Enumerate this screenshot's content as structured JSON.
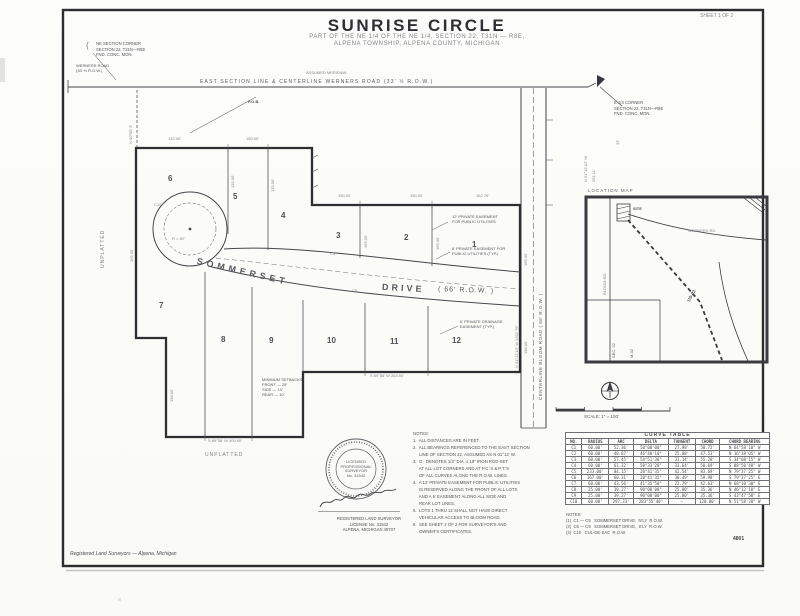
{
  "doc": {
    "title": "SUNRISE CIRCLE",
    "subtitle_line1": "PART OF THE NE 1/4 OF THE NE 1/4, SECTION 22, T31N — R8E,",
    "subtitle_line2": "ALPENA TOWNSHIP, ALPENA COUNTY, MICHIGAN",
    "sheet_note": "SHEET 1 OF 2",
    "footer_left": "Registered Land Surveyors — Alpena, Michigan",
    "footer_right": "4801"
  },
  "top": {
    "corner_bracket": "{",
    "corner_note_nw": [
      "NE SECTION CORNER",
      "SECTION 22, T31N—R8E",
      "FND. CONC. MON."
    ],
    "road_label_1": "WERNERS ROAD",
    "road_label_2": "(33' ½ R.O.W.)",
    "meridian_note": "ASSUMED MERIDIAN",
    "section_line_label": "EAST SECTION LINE & CENTERLINE WERNERS ROAD (33' ½ R.O.W.)",
    "pob_label": "P.O.B.",
    "corner_note_ne": [
      "E 1/4 CORNER",
      "SECTION 22, T31N—R8E",
      "FND. CONC. MON."
    ]
  },
  "plat": {
    "lots": [
      "1",
      "2",
      "3",
      "4",
      "5",
      "6",
      "7",
      "8",
      "9",
      "10",
      "11",
      "12"
    ],
    "street_name": "SOMMERSET",
    "street_type": "DRIVE",
    "street_row": "( 66'  R.O.W. )",
    "easement_note1": [
      "12' PRIVATE EASEMENT",
      "FOR PUBLIC UTILITIES"
    ],
    "easement_note2": [
      "6' PRIVATE EASEMENT FOR",
      "PUBLIC UTILITIES (TYP.)"
    ],
    "easement_note3": [
      "6' PRIVATE DRAINAGE",
      "EASEMENT (TYP.)"
    ],
    "setback_note": [
      "MINIMUM SETBACKS:",
      "FRONT — 25'",
      "SIDE — 10'",
      "REAR — 10'"
    ],
    "unplatted_left": "UNPLATTED",
    "unplatted_lower": "UNPLATTED",
    "culdesac_radius": "R = 60'",
    "curve_ref_c10": "C10",
    "curve_ref_c5": "C5",
    "curve_ref_c6": "C6"
  },
  "east_road": {
    "name": "CENTERLINE  BLOOM ROAD  ( 66'  R.O.W. )",
    "bearing": "N 01°12'10\" W    1322.76'",
    "tick1": "N 01°12'10\" W",
    "tick2": "261.11'",
    "tick3": "33'"
  },
  "dims": [
    "132.00'",
    "150.00'",
    "150.00'",
    "150.00'",
    "162.76'",
    "165.00'",
    "198.00'",
    "S 89°58' W   264.00'",
    "S 89°58' W   300.00'",
    "165.00'",
    "132.00'",
    "132.00'",
    "165.00'",
    "165.00'",
    "198.00'",
    "N 00°05' E"
  ],
  "inset": {
    "caption": "LOCATION  MAP",
    "site": "SITE",
    "road1": "WERNERS RD.",
    "hwy": "US-23",
    "road2": "BLOOM RD.",
    "sec": "SEC. 22",
    "m32": "M-32"
  },
  "scale_bar": {
    "label": "SCALE:  1\" = 100'"
  },
  "curve_table": {
    "title": "CURVE  TABLE",
    "headers": [
      "NO.",
      "RADIUS",
      "ARC",
      "DELTA",
      "TANGENT",
      "CHORD",
      "CHORD BEARING"
    ],
    "rows": [
      [
        "C1",
        "60.00'",
        "52.36'",
        "50°00'00\"",
        "27.98'",
        "50.72'",
        "N 64°58'10\" W"
      ],
      [
        "C2",
        "60.00'",
        "48.87'",
        "46°40'10\"",
        "25.88'",
        "47.53'",
        "N 16°38'05\" W"
      ],
      [
        "C3",
        "60.00'",
        "57.45'",
        "54°51'30\"",
        "31.14'",
        "55.28'",
        "S 34°08'15\" W"
      ],
      [
        "C4",
        "60.00'",
        "61.32'",
        "58°33'20\"",
        "33.64'",
        "58.69'",
        "S 88°50'40\" W"
      ],
      [
        "C5",
        "233.00'",
        "84.15'",
        "20°41'35\"",
        "42.54'",
        "83.69'",
        "N 79°37'25\" W"
      ],
      [
        "C6",
        "167.00'",
        "60.31'",
        "20°41'35\"",
        "30.49'",
        "59.98'",
        "S 79°37'25\" E"
      ],
      [
        "C7",
        "60.00'",
        "43.56'",
        "41°35'50\"",
        "22.79'",
        "42.61'",
        "N 68°10'30\" E"
      ],
      [
        "C8",
        "25.00'",
        "39.27'",
        "90°00'00\"",
        "25.00'",
        "35.36'",
        "N 46°12'10\" E"
      ],
      [
        "C9",
        "25.00'",
        "39.27'",
        "90°00'00\"",
        "25.00'",
        "35.36'",
        "S 43°47'50\" E"
      ],
      [
        "C10",
        "60.00'",
        "297.33'",
        "283°55'40\"",
        "—",
        "120.00'",
        "N 51°58'20\" W"
      ]
    ],
    "notes": [
      "NOTES:",
      "(1)  C1 — C5   SOMMERSET DRIVE,  N'LY  R.O.W.",
      "(2)  C6 — C9   SOMMERSET DRIVE,  S'LY  R.O.W.",
      "(3)  C10   CUL-DE-SAC  R.O.W."
    ]
  },
  "notes": {
    "lines": [
      "NOTES:",
      "1.  ALL DISTANCES ARE IN FEET.",
      "2.  ALL BEARINGS REFERENCED TO THE EAST SECTION",
      "     LINE OF SECTION 22, ASSUMED AS N 01°12' W.",
      "3.  O   DENOTES 1/2\" DIA. x 18\" IRON ROD SET",
      "     AT ALL LOT CORNERS AND AT P.C.'S & P.T.'S",
      "     OF ALL CURVES ALONG THE R.O.W. LINES.",
      "4.  A 12' PRIVATE EASEMENT FOR PUBLIC UTILITIES",
      "     IS RESERVED ALONG THE FRONT OF ALL LOTS",
      "     AND A 6' EASEMENT ALONG ALL SIDE AND",
      "     REAR LOT LINES.",
      "5.  LOTS 1 THRU 12 SHALL NOT HAVE DIRECT",
      "     VEHICULAR ACCESS TO BLOOM ROAD.",
      "6.  SEE SHEET 2 OF 2 FOR SURVEYOR'S AND",
      "     OWNER'S CERTIFICATES."
    ]
  },
  "seal": {
    "center_lines": [
      "LICENSED",
      "PROFESSIONAL",
      "SURVEYOR",
      "No. 31542"
    ],
    "typed_lines": [
      "REGISTERED LAND SURVEYOR",
      "LICENSE No. 31542",
      "ALPENA, MICHIGAN  49707"
    ]
  }
}
